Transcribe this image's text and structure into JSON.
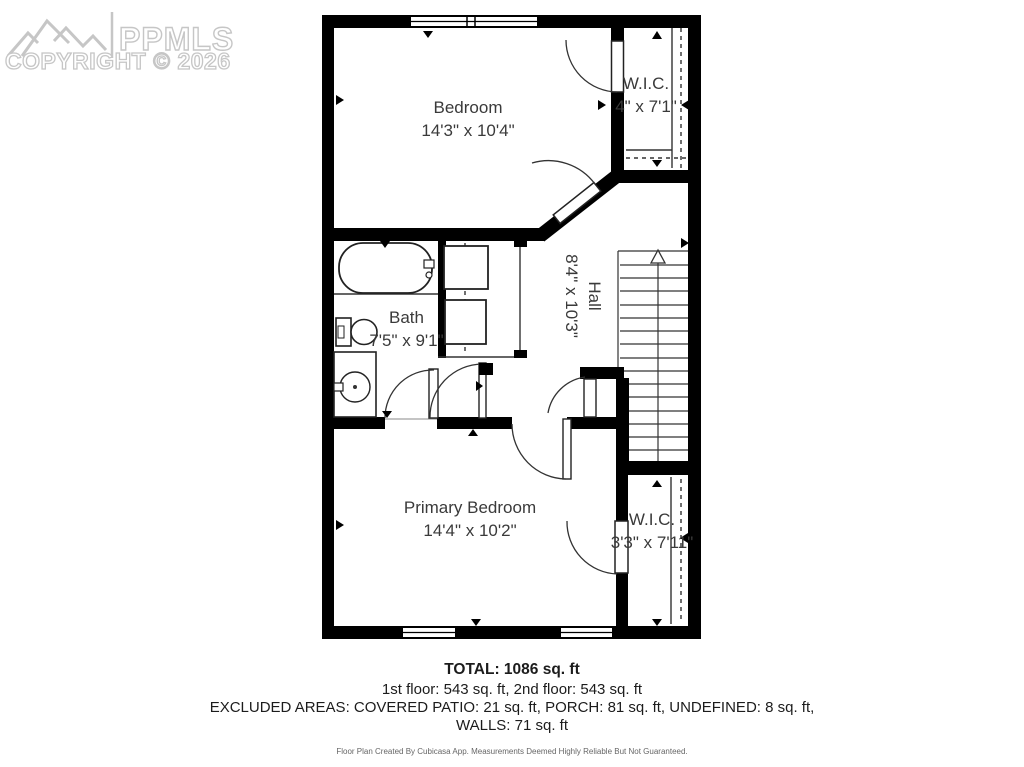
{
  "watermark": {
    "brand": "PPMLS",
    "copyright": "COPYRIGHT © 2026"
  },
  "rooms": {
    "bedroom": {
      "name": "Bedroom",
      "dims": "14'3\" x 10'4\""
    },
    "wic_top": {
      "name": "W.I.C.",
      "dims": "4\" x 7'1\""
    },
    "bath": {
      "name": "Bath",
      "dims": "7'5\" x 9'1\""
    },
    "hall": {
      "name": "Hall",
      "dims": "8'4\" x 10'3\""
    },
    "primary_bedroom": {
      "name": "Primary Bedroom",
      "dims": "14'4\" x 10'2\""
    },
    "wic_bottom": {
      "name": "W.I.C.",
      "dims": "3'3\" x 7'11\""
    }
  },
  "summary": {
    "total": "TOTAL: 1086 sq. ft",
    "floors": "1st floor: 543 sq. ft, 2nd floor: 543 sq. ft",
    "excluded": "EXCLUDED AREAS: COVERED PATIO: 21 sq. ft, PORCH: 81 sq. ft, UNDEFINED: 8 sq. ft,",
    "walls": "WALLS: 71 sq. ft",
    "disclaimer": "Floor Plan Created By Cubicasa App. Measurements Deemed Highly Reliable But Not Guaranteed."
  },
  "colors": {
    "wall": "#000000",
    "thin_line": "#333333",
    "label_text": "#3a3a3a",
    "watermark": "#c6c6c6"
  }
}
